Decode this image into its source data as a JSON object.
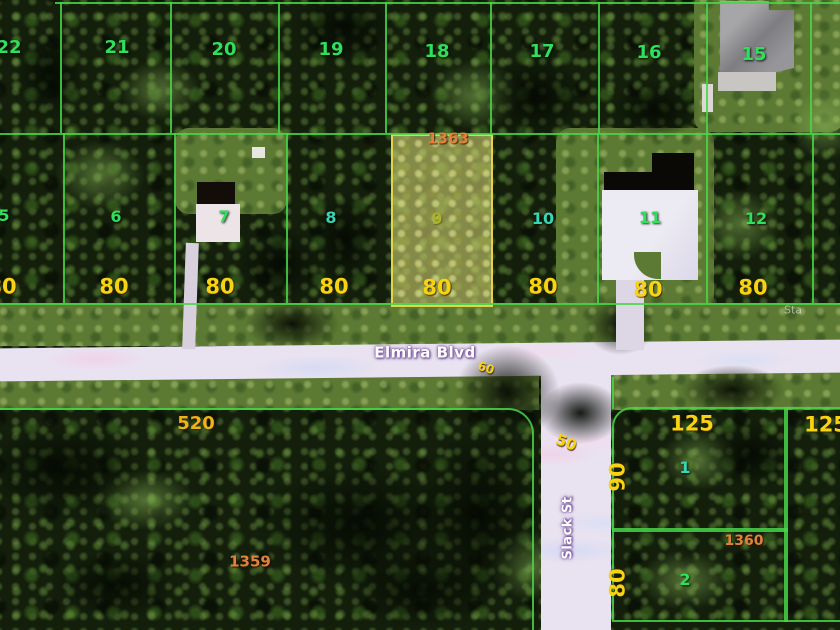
{
  "streets": {
    "horizontal": "Elmira Blvd",
    "vertical": "Slack St",
    "faint_right": "Sta"
  },
  "top_row": {
    "lots": [
      "22",
      "21",
      "20",
      "19",
      "18",
      "17",
      "16",
      "15"
    ]
  },
  "mid_row": {
    "lots": [
      "5",
      "6",
      "7",
      "8",
      "9",
      "10",
      "11",
      "12"
    ],
    "frontages": [
      "80",
      "80",
      "80",
      "80",
      "80",
      "80",
      "80",
      "80"
    ]
  },
  "block_labels": {
    "north": "1363",
    "southwest_front": "520",
    "southwest_rear": "1359",
    "southeast": "1360"
  },
  "road_widths": {
    "elmira": "60",
    "slack": "50"
  },
  "south_lots": {
    "lot_1": {
      "number": "1",
      "frontage": "125",
      "depth": "90"
    },
    "lot_2": {
      "number": "2",
      "depth": "80"
    },
    "far_right_frontage": "125"
  },
  "colors": {
    "parcel_line": "#48d648",
    "highlight_border": "#e2d44e",
    "highlight_fill": "#d0d270",
    "lot_number_green": "#2ee05a",
    "lot_number_teal": "#38d6b6",
    "dimension_yellow": "#f8d312",
    "block_orange": "#e2823a",
    "road_fill": "#e9e2f0",
    "street_text": "#ffffff"
  }
}
